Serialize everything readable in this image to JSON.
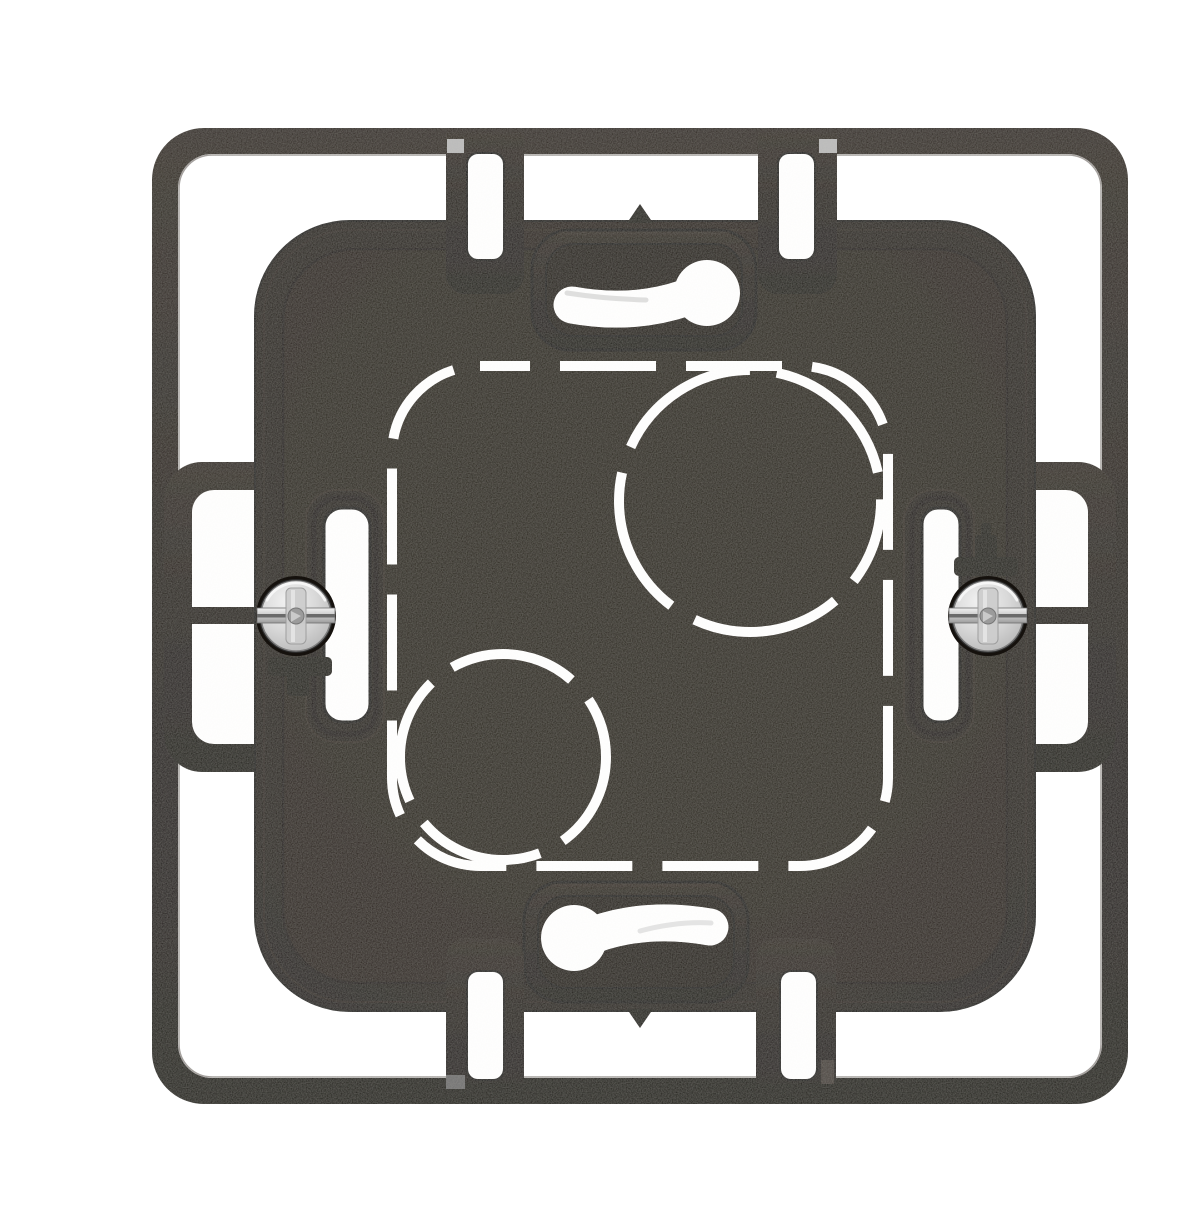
{
  "meta": {
    "caption": "Front view product photo of a black single-gang flush-mount electrical back box mounting frame with two metal fixing screws, two keyhole screw slots, four slotted spacer tabs, orientation arrows and dashed knockout markings, on a white background."
  },
  "scene": {
    "background_color": "#ffffff",
    "object": "flush-mount electrical box mounting frame",
    "view": "front",
    "finish": "matte black plastic",
    "palette": {
      "plastic": "#211b15",
      "plastic_deep": "#18130e",
      "panel": "#272019",
      "edge_dark": "#120d09",
      "edge_light": "#372f26",
      "marking_white": "#ffffff",
      "screw_light": "#ededed",
      "screw_mid": "#c4c4c4",
      "screw_dark": "#8f8f8f",
      "tick_light": "#b9b9b9",
      "tick_dim": "#6f6f6f",
      "tick_faint": "#46413a"
    },
    "components": {
      "outer_frame": {
        "label": "outer mounting frame"
      },
      "body": {
        "label": "box body"
      },
      "screws": {
        "label": "fixing screws",
        "count": 2,
        "head_type": "slotted combo head"
      },
      "keyholes": {
        "label": "keyhole screw slots",
        "count": 2
      },
      "tabs": {
        "label": "spacer tabs with slots",
        "count": 4
      },
      "claws": {
        "label": "claw support arms",
        "count": 2
      },
      "knockouts": {
        "label": "dashed knockout markings",
        "squares": 1,
        "circles": 2
      },
      "arrows": {
        "label": "orientation arrows",
        "count": 2
      }
    }
  }
}
